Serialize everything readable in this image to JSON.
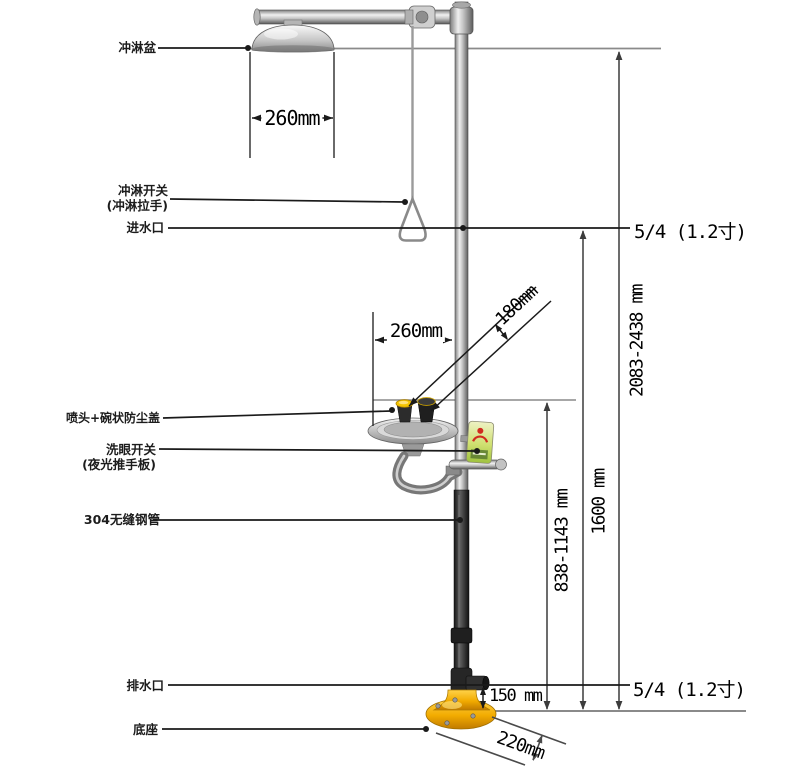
{
  "labels": {
    "shower_head": "冲淋盆",
    "shower_switch": "冲淋开关",
    "shower_switch_sub": "(冲淋拉手)",
    "water_inlet": "进水口",
    "spray_dust_cap": "喷头+碗状防尘盖",
    "eyewash_switch": "洗眼开关",
    "eyewash_switch_sub": "(夜光推手板)",
    "steel_pipe": "304无缝钢管",
    "drain_outlet": "排水口",
    "base": "底座"
  },
  "dimensions": {
    "shower_head_width": "260mm",
    "inlet_pipe_size": "5/4 (1.2寸)",
    "overall_height": "2083-2438 mm",
    "inlet_height": "1600 mm",
    "eyewash_bowl_height": "838-1143 mm",
    "eyewash_bowl_width": "260mm",
    "nozzle_dimension": "180mm",
    "drain_height": "150 mm",
    "drain_pipe_size": "5/4 (1.2寸)",
    "base_diameter": "220mm"
  },
  "colors": {
    "accent_yellow": "#f2b400",
    "chrome_light": "#e8e8e8",
    "chrome_dark": "#6a6a6a",
    "pipe_black": "#1f1f1f",
    "line_black": "#1a1a1a",
    "line_gray": "#8a8a8a",
    "sign_green": "#b5d24a",
    "sign_red": "#d12b1f"
  }
}
